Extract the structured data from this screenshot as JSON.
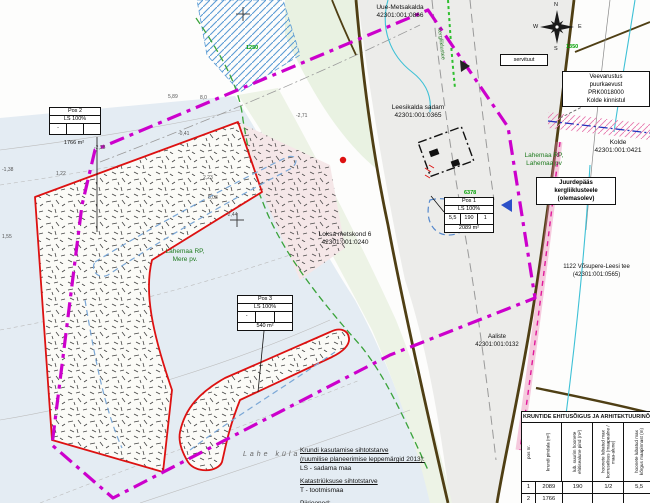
{
  "labels": {
    "uue_metsakalda": {
      "name": "Uue-Metsakalda",
      "code": "42301:001:0866"
    },
    "servituut": "servituut",
    "veevarustus": {
      "l1": "Veevarustus",
      "l2": "puurkaevust",
      "l3": "PRK0018000",
      "l4": "Kolde kinnistul"
    },
    "leesikalda": {
      "name": "Leesikalda sadam",
      "code": "42301:001:0365"
    },
    "kolde": {
      "name": "Kolde",
      "code": "42301:001:0421"
    },
    "lahemaa_lahe": {
      "l1": "Lahemaa RP,",
      "l2": "Lahemaa pv"
    },
    "juurdepaas": {
      "l1": "Juurdepääs",
      "l2": "kergliiklusteele",
      "l3": "(olemasolev)"
    },
    "vosupere": {
      "name": "1122 Võsupere-Leesi tee",
      "code": "(42301:001:0565)"
    },
    "loksa": {
      "name": "Loksa metskond 6",
      "code": "42301:001:0240"
    },
    "lahemaa_mere": {
      "l1": "Lahemaa RP,",
      "l2": "Mere pv."
    },
    "aaliste": {
      "name": "Aaliste",
      "code": "42301:001:0132"
    },
    "lahe_kyla": "Lahe küla",
    "kergliiklustee": "kergliiklustee"
  },
  "compass": {
    "n": "N",
    "e": "E",
    "s": "S",
    "w": "W"
  },
  "pos_boxes": {
    "pos1": {
      "title": "Pos 1",
      "use": "LS 100%",
      "c1": "5,5",
      "c2": "190",
      "c3": "1",
      "area": "2089 m²"
    },
    "pos2": {
      "title": "Pos 2",
      "use": "LS 100%",
      "c1": "-",
      "c2": "",
      "c3": "",
      "area": "1766 m²"
    },
    "pos3": {
      "title": "Pos 3",
      "use": "LS 100%",
      "c1": "-",
      "c2": "",
      "c3": "",
      "area": "540 m²"
    }
  },
  "green_numbers": [
    "1250",
    "6378",
    "1350"
  ],
  "elevations": [
    "-2,71",
    "-0,41",
    "2,23",
    "-1,38",
    "1,55",
    "6,03",
    "-2,44",
    "5,89",
    "8,0",
    "-2,28",
    "1,22"
  ],
  "legend": {
    "h1": "Krundi kasutamise sihtotstarve",
    "h1b": "(ruumilise planeerimise leppemärgid 2013):",
    "i1": "LS - sadama maa",
    "h2": "Katastriüksuse sihtotstarve",
    "i2": "T - tootmismaa",
    "h3": "Piirjooned:"
  },
  "table": {
    "title": "KRUNTIDE EHITUSÕIGUS JA ARHITEKTUURINÕUDED",
    "headers": [
      "pos nr.",
      "krundi pindala (m²)",
      "lub. suurim hoonete ehitisealune pind (m²)",
      "hoonete lubatud max korruselisus (maapealne / maa-alune)",
      "hoonete lubatud max kõrgus maapinnast (m)"
    ],
    "rows": [
      [
        "1",
        "2089",
        "190",
        "1/2",
        "5,5"
      ],
      [
        "2",
        "1766",
        "",
        "",
        ""
      ]
    ]
  },
  "colors": {
    "boundary": "#cc00cc",
    "parcel": "#dd1111",
    "water": "#e4ecf3",
    "road": "#4f3f14",
    "coast": "#3aa33a",
    "stream": "#3ec1d6",
    "pink": "#e0189a"
  }
}
